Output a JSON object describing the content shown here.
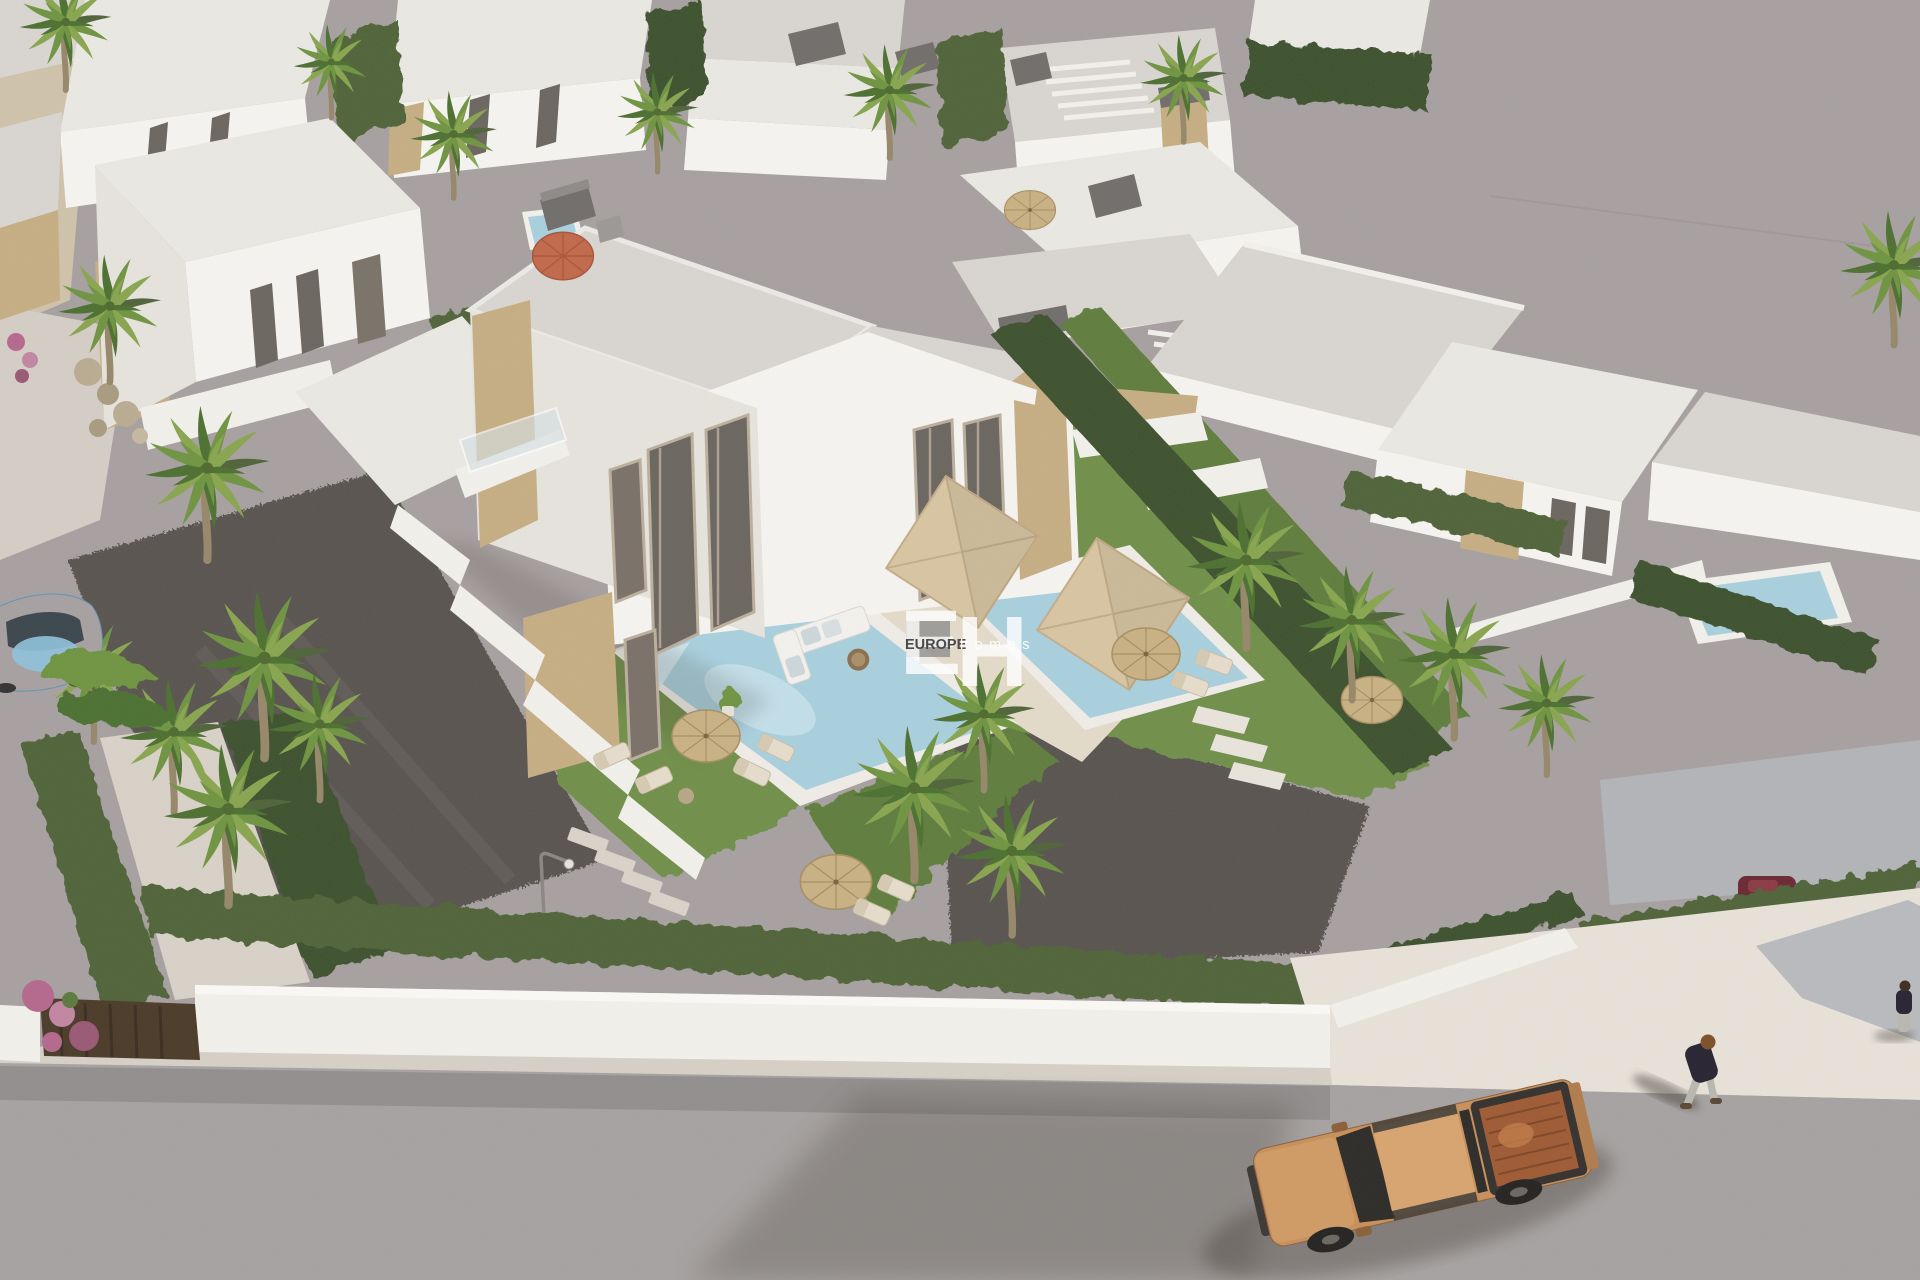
{
  "scene": {
    "description": "Aerial 3D architectural rendering of a development of modern white villas with private pools, palm trees and gardens; an orange pickup truck is parked on the street and a pedestrian walks on the sidewalk."
  },
  "watermark": {
    "initial_e": "E",
    "initial_h": "H",
    "brand": "EUROPE",
    "suffix": "homes"
  },
  "palette": {
    "bg": "#a7a0a0",
    "road": "#a6a2a1",
    "sidewalk": "#e8e2d9",
    "curb": "#d7d0c7",
    "drive-gray": "#b4b6ba",
    "wall-white": "#f3f1ec",
    "facade-light": "#f7f5f1",
    "facade-shade": "#e7e4de",
    "roof": "#d9d6d1",
    "roof-light": "#ebe9e4",
    "roof-box": "#716d6b",
    "stone": "#c6ae83",
    "stone-dark": "#a78d62",
    "glass": "#6b655f",
    "curtain": "#bbaf9d",
    "hedge": "#4f6339",
    "hedge-dark": "#3e512d",
    "lawn": "#6f8f4a",
    "lawn-shade": "#5e7d3d",
    "gravel": "#595350",
    "pool-water": "#a9d0de",
    "pool-floor": "#cde6ee",
    "deck": "#e4dbc9",
    "parasol-tan": "#d8c5a2",
    "parasol-straw": "#c9b183",
    "parasol-orange": "#c2684a",
    "trunk": "#97876a",
    "palm-1": "#4c7030",
    "palm-2": "#6e9440",
    "palm-3": "#88a54e",
    "truck-body": "#c88f5a",
    "truck-roof": "#d7a46e",
    "truck-bed": "#9e5a33",
    "truck-dark": "#2c2a28",
    "car-blue": "#7ab3d6",
    "flower-pink": "#b5688c",
    "person-top": "#262231",
    "person-pants": "#bab6b0",
    "hair": "#7c4f28",
    "shadow": "#3a342e",
    "watermark-white": "#ffffff",
    "watermark-gray": "#4b4b4b"
  }
}
